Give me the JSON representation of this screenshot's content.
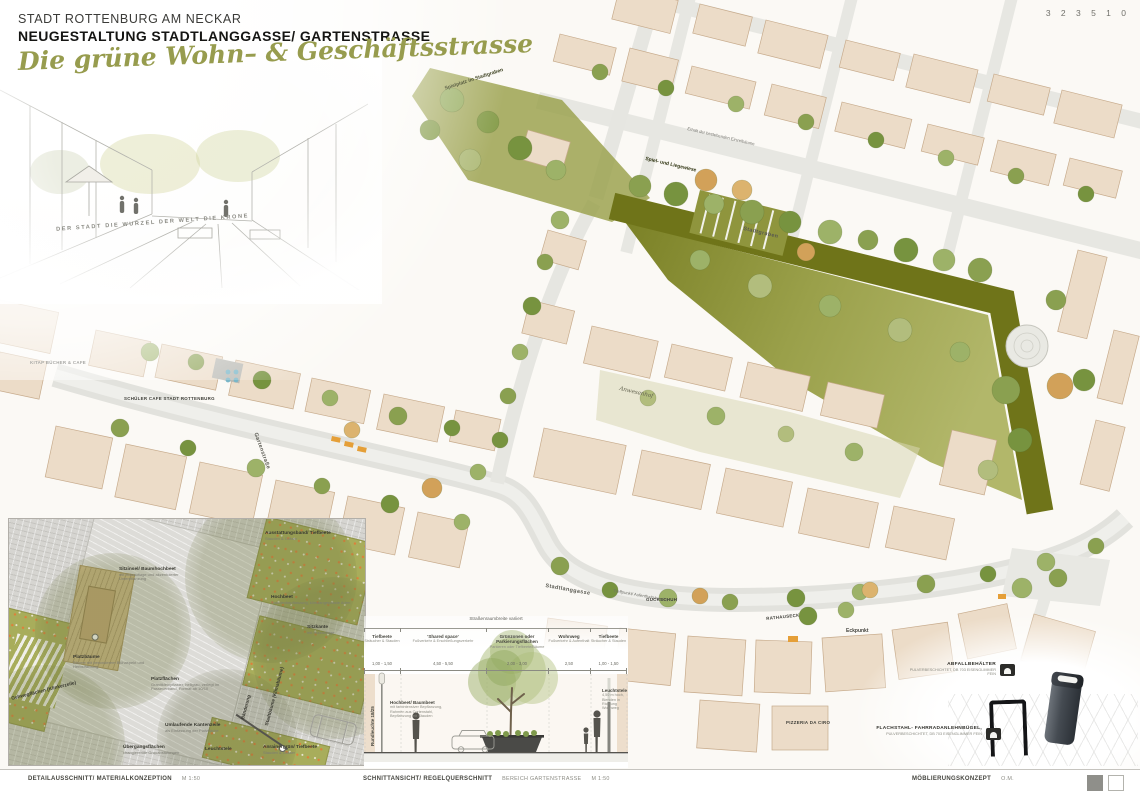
{
  "board": {
    "number": "3 2 3 5 1 0"
  },
  "header": {
    "city": "STADT ROTTENBURG AM NECKAR",
    "project": "NEUGESTALTUNG STADTLANGGASSE/ GARTENSTRASSE",
    "tagline": "Die grüne Wohn– & Geschäftsstrasse"
  },
  "sketch": {
    "caption": "DER STADT DIE WURZEL DER WELT DIE KRONE"
  },
  "plan": {
    "labels": [
      {
        "t": "Spielplatz im Stadtgraben",
        "x": 444,
        "y": 86,
        "r": -18,
        "c": "pl-name pl-green"
      },
      {
        "t": "Spiel- und Liegewiese",
        "x": 646,
        "y": 156,
        "r": 13,
        "c": "pl-name pl-green"
      },
      {
        "t": "Stadtgraben",
        "x": 744,
        "y": 226,
        "r": 13,
        "c": "pl-street"
      },
      {
        "t": "Erhalt der bestehenden Einzelbäume",
        "x": 688,
        "y": 126,
        "r": 13,
        "c": "pl-note"
      },
      {
        "t": "Anwesenhof",
        "x": 620,
        "y": 386,
        "r": 13,
        "c": "pl-italic"
      },
      {
        "t": "Gartenstraße",
        "x": 258,
        "y": 432,
        "r": 70,
        "c": "pl-street"
      },
      {
        "t": "Stadtlanggasse",
        "x": 546,
        "y": 583,
        "r": 10,
        "c": "pl-street"
      },
      {
        "t": "Treffpunkt/ Aufenthaltsbereich",
        "x": 614,
        "y": 588,
        "r": 10,
        "c": "pl-note"
      },
      {
        "t": "GUCKSCHUH",
        "x": 646,
        "y": 597,
        "r": 0,
        "c": "pl-caps"
      },
      {
        "t": "RATHAUSECK",
        "x": 766,
        "y": 616,
        "r": -6,
        "c": "pl-caps"
      },
      {
        "t": "Eckpunkt",
        "x": 846,
        "y": 628,
        "r": 0,
        "c": "pl-name"
      },
      {
        "t": "PIZZERIA DA CIRO",
        "x": 786,
        "y": 720,
        "r": 0,
        "c": "pl-caps"
      },
      {
        "t": "SCHÜLER CAFE STADT ROTTENBURG",
        "x": 124,
        "y": 396,
        "r": 0,
        "c": "pl-caps"
      },
      {
        "t": "KITAP BÜCHER & CAFE",
        "x": 30,
        "y": 360,
        "r": 0,
        "c": "pl-caps"
      }
    ]
  },
  "detail": {
    "labels": [
      {
        "t": "Sitzinsel/ Baumhochbeet",
        "s": "mit Holzauflage und akzentuierter Unterpflanzung",
        "x": 110,
        "y": 48,
        "r": 0
      },
      {
        "t": "Platzbäume",
        "s": "Bäume mit besonderem Blühaspekt und Herbstfärbung",
        "x": 64,
        "y": 136,
        "r": 0
      },
      {
        "t": "Platzflächen",
        "s": "Granitkleinpflaster, hellgrau, verlegt im Passeverband, Format ab 10/10",
        "x": 142,
        "y": 158,
        "r": 0
      },
      {
        "t": "Hochbeet",
        "s": "Staudenbepflanzung, klimaangepasste Arten",
        "x": 262,
        "y": 76,
        "r": 0
      },
      {
        "t": "Sitzkante",
        "s": "mit Holzauflage",
        "x": 298,
        "y": 106,
        "r": 0
      },
      {
        "t": "Ausstattungsband/ Tiefbeete",
        "s": "Stauden & Gräser",
        "x": 256,
        "y": 12,
        "r": 0
      },
      {
        "t": "Gehwegflächen (Klinkerzeile)",
        "s": "",
        "x": 2,
        "y": 178,
        "r": -14
      },
      {
        "t": "Umlaufende Kantenzeile",
        "s": "als Einfassung der Platzfläche",
        "x": 156,
        "y": 204,
        "r": 0
      },
      {
        "t": "Übergangsflächen",
        "s": "changierende Grauabstufungen",
        "x": 114,
        "y": 226,
        "r": 0
      },
      {
        "t": "Leuchtstele",
        "s": "",
        "x": 196,
        "y": 228,
        "r": 0
      },
      {
        "t": "Anrainergrün/ Tiefbeete",
        "s": "Stauden & Gräser",
        "x": 254,
        "y": 226,
        "r": 0
      },
      {
        "t": "Bänderung",
        "s": "",
        "x": 232,
        "y": 200,
        "r": -75
      },
      {
        "t": "Stadtbäume (Klimabäume)",
        "s": "",
        "x": 256,
        "y": 206,
        "r": -75
      }
    ]
  },
  "section": {
    "overall_note": "Straßenraumbreite variiert",
    "zones": [
      {
        "label": "Tiefbeete",
        "sub": "Sträucher & Stauden",
        "dim": "1,00 - 1,50"
      },
      {
        "label": "'Shared space'",
        "sub": "Fußverkehr & Erschließungsverkehr",
        "dim": "4,50 - 5,50"
      },
      {
        "label": "Grünzonen oder Parkierungsflächen",
        "sub": "Parkieren oder Tiefbeete/Bäume",
        "dim": "2,00 - 3,00"
      },
      {
        "label": "Wohnweg",
        "sub": "Fußverkehr & Aufenthalt",
        "dim": "2,50"
      },
      {
        "label": "Tiefbeete",
        "sub": "Sträucher & Stauden",
        "dim": "1,00 - 1,50"
      }
    ],
    "annotations": [
      {
        "text": "Hochbeet/ Baumbeet",
        "sub": "mit farbintensiver Bepflanzung, Rahmen aus Cortenstahl, Bepflanzung mit Stauden",
        "x": 26,
        "y": 84,
        "r": 0
      },
      {
        "text": "Leuchtstele",
        "sub": "4,50 m hoch, Blenden in Richtung Wohnweg",
        "x": 238,
        "y": 72,
        "r": 0
      },
      {
        "text": "Rundleuchte 18/25",
        "sub": "",
        "x": 6,
        "y": 130,
        "r": -90
      }
    ]
  },
  "furniture": {
    "bin_label": "ABFALLBEHÄLTER",
    "bin_sub": "PULVERBESCHICHTET, DB 703 EISENGLIMMER FEIN",
    "bike_label": "FLACHSTAHL- FAHRRADANLEHNBÜGEL,",
    "bike_sub": "PULVERBESCHICHTET, DB 703 EISENGLIMMER FEIN"
  },
  "footer": {
    "left_title": "DETAILAUSSCHNITT/ MATERIALKONZEPTION",
    "left_scale": "M 1:50",
    "center_title": "SCHNITTANSICHT/ REGELQUERSCHNITT",
    "center_area": "BEREICH GARTENSTRASSE",
    "center_scale": "M 1:50",
    "right_title": "MÖBLIERUNGSKONZEPT",
    "right_author": "O.M."
  },
  "colors": {
    "park_band": "#6f7419",
    "lawn": "#a8ad58",
    "building": "#ecdcc8",
    "street": "#e3e3df",
    "title_script": "#979c4e"
  }
}
